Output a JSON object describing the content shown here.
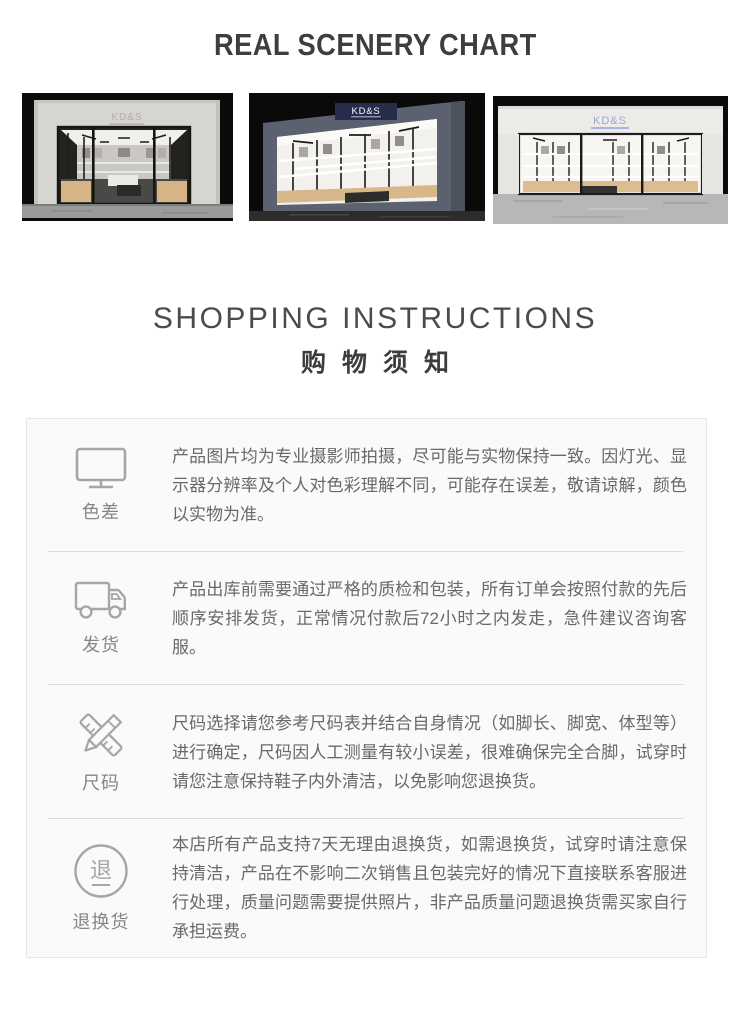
{
  "header": {
    "title": "REAL SCENERY CHART"
  },
  "gallery": {
    "brand": "KD&S",
    "photos": [
      {
        "name": "storefront-front-view"
      },
      {
        "name": "storefront-angled-view"
      },
      {
        "name": "storefront-wide-view"
      }
    ]
  },
  "shopping": {
    "title_en": "SHOPPING INSTRUCTIONS",
    "title_zh": "购物须知"
  },
  "notices": [
    {
      "id": "color-difference",
      "icon": "monitor-icon",
      "label": "色差",
      "text": "产品图片均为专业摄影师拍摄，尽可能与实物保持一致。因灯光、显示器分辨率及个人对色彩理解不同，可能存在误差，敬请谅解，颜色以实物为准。"
    },
    {
      "id": "shipping",
      "icon": "truck-icon",
      "label": "发货",
      "text": "产品出库前需要通过严格的质检和包装，所有订单会按照付款的先后顺序安排发货，正常情况付款后72小时之内发走，急件建议咨询客服。"
    },
    {
      "id": "sizing",
      "icon": "pencil-ruler-icon",
      "label": "尺码",
      "text": "尺码选择请您参考尺码表并结合自身情况（如脚长、脚宽、体型等）进行确定，尺码因人工测量有较小误差，很难确保完全合脚，试穿时请您注意保持鞋子内外清洁，以免影响您退换货。"
    },
    {
      "id": "returns",
      "icon": "return-circle-icon",
      "icon_char": "退",
      "label": "退换货",
      "text": "本店所有产品支持7天无理由退换货，如需退换货，试穿时请注意保持清洁，产品在不影响二次销售且包装完好的情况下直接联系客服进行处理，质量问题需要提供照片，非产品质量问题退换货需买家自行承担运费。"
    }
  ],
  "colors": {
    "title_text": "#3e3e3e",
    "body_text": "#696969",
    "label_text": "#868686",
    "icon_stroke": "#a6a6a6",
    "box_background": "#fafafa",
    "box_border": "#e6e6e6",
    "divider": "#dcdcdc",
    "sign_navy": "#272c4b",
    "sign_blue": "#9aa7d6",
    "wood_tone": "#d5b586"
  }
}
